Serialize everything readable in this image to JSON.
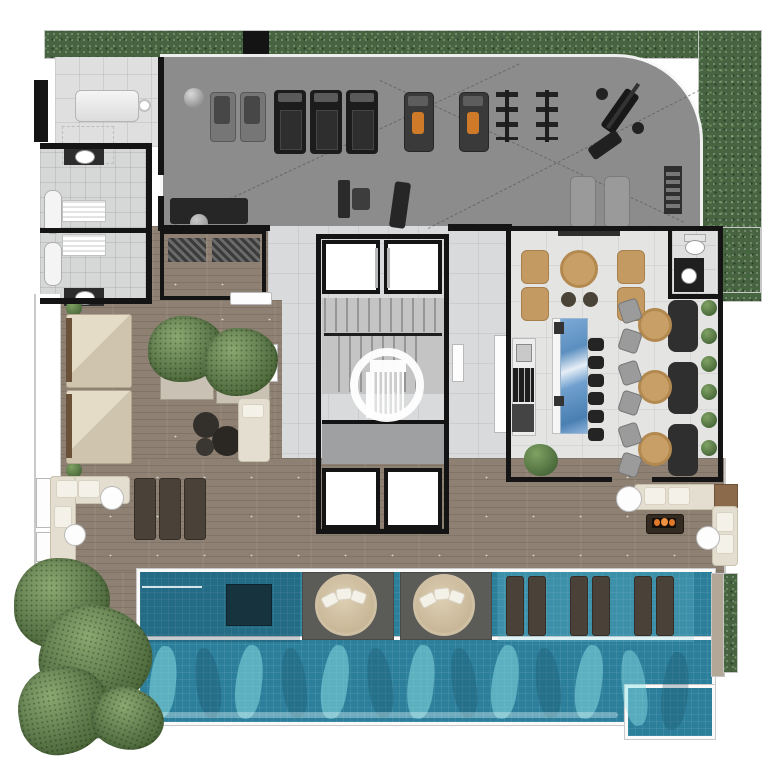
{
  "meta": {
    "description": "Top-down rendered architectural floor plan of a residential amenity level: fitness room, massage room, changing rooms, elevator core with stairs, gourmet lounge with kitchen island and dining banquettes, wood-deck lounges, outdoor terrace with fire pit and a large swimming pool with tanning ledge, all wrapped by hedge and grass landscaping.",
    "view": "top-down plan render",
    "visible_text": ""
  },
  "palette": {
    "page_background": "#ffffff",
    "gym_floor": "#8c8c8c",
    "wood_deck": "#8e8173",
    "hedge_green": "#466440",
    "grass_green": "#4a6c41",
    "pool_water": "#2e86a2",
    "pool_ledge": "#2c7f9b",
    "wall_black": "#141414",
    "tile_light": "#dfdfdf",
    "island_marble_blue": "#5b8fc0",
    "seat_beige": "#d6cdb8",
    "machine_seat_orange": "#cf7a28",
    "fire_orange": "#e07a2a",
    "watermark_white": "#ffffff"
  },
  "regions": {
    "gym": {
      "name": "fitness-room",
      "floor": "gray sport floor with dashed layout lines",
      "equipment": {
        "treadmills": 3,
        "incline_benches": 2,
        "strength_machines_orange_seat": 2,
        "weight_racks": 2,
        "bench_press_station": 1,
        "exercise_ball": 1,
        "mats": 2,
        "cable_machine": 1,
        "rower": 1,
        "wall_ladder": 1,
        "bench_sofa": 1
      }
    },
    "spa": {
      "name": "massage-room",
      "equipment": {
        "massage_tables": 1
      }
    },
    "changing_rooms": {
      "name": "changing-rooms",
      "count": 2,
      "fixtures": {
        "toilets": 2,
        "bathtubs": 2,
        "towel_shelves": 2
      }
    },
    "storage": {
      "name": "storage-room",
      "fixtures": {
        "shelf_units": 2,
        "bench": 1
      }
    },
    "core": {
      "name": "elevator-core",
      "elevators_top": 2,
      "elevators_bottom": 2,
      "stair_flights": 2
    },
    "gourmet_lounge": {
      "name": "gourmet-lounge",
      "furniture": {
        "armchairs": 4,
        "round_coffee_table": 1,
        "poufs": 2,
        "dining_tables": 3,
        "banquettes": 3,
        "dining_chairs": 6,
        "island_stools": 6,
        "kitchen_island_marble": 1,
        "wall_kitchen_counter": 1,
        "planter_pot": 1,
        "wall_hedge_bushes": 6
      },
      "powder_room": {
        "toilet": 1,
        "black_vanity_sink": 1
      }
    },
    "deck_lounge": {
      "name": "wood-deck-lounge",
      "furniture": {
        "daybeds": 2,
        "tree_planters": 2,
        "round_ottomans": 3,
        "corner_bench": 1,
        "shrubs": 2
      }
    },
    "terrace_left": {
      "name": "terrace-left",
      "furniture": {
        "corner_sofa": 1,
        "side_tables": 2,
        "sun_loungers": 3
      }
    },
    "terrace_right": {
      "name": "terrace-right",
      "furniture": {
        "corner_sofa": 1,
        "wood_corner_table": 1,
        "fire_pit": 1,
        "side_tables": 2
      }
    },
    "pool": {
      "name": "swimming-pool",
      "features": {
        "round_daybeds_on_islands": 2,
        "submerged_loungers": 6,
        "wet_deck_bench": 1,
        "tanning_ledge": true,
        "wave_reflections": true
      }
    },
    "landscape": {
      "name": "perimeter-landscaping",
      "features": {
        "top_hedge_band": 1,
        "right_hedge_band": 1,
        "pool_side_hedge": 1,
        "grass_corner": 1,
        "trees": 5
      }
    }
  },
  "watermark": {
    "name": "developer-logo",
    "shape": "stylized striped building inside white ring",
    "color": "#ffffff"
  }
}
